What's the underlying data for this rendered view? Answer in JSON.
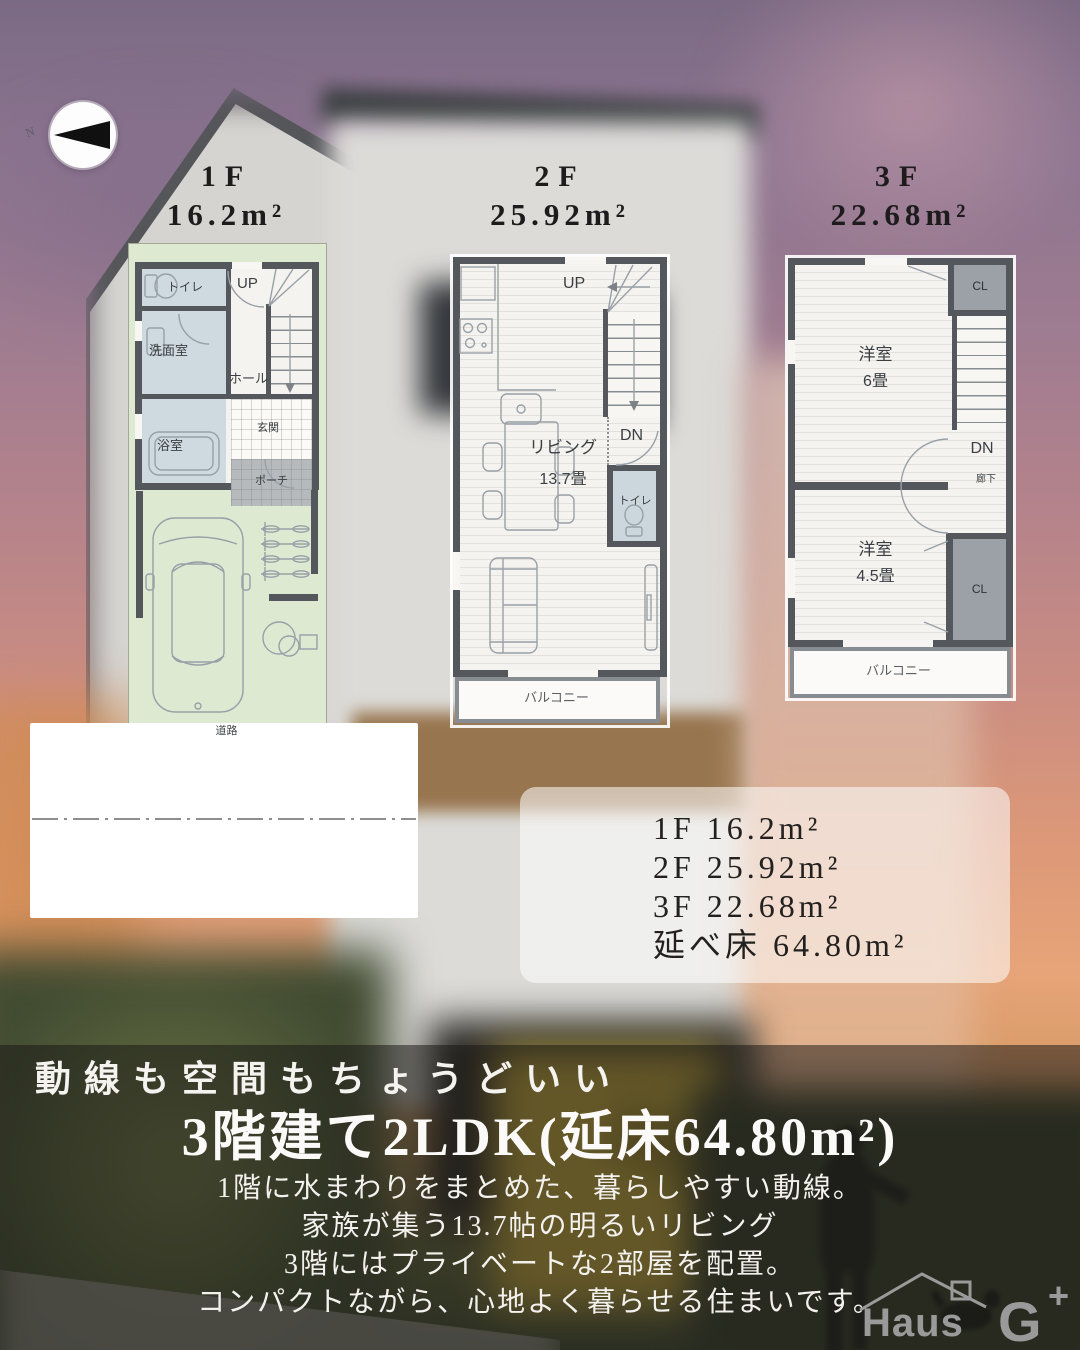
{
  "compass": {
    "north": "N"
  },
  "floor_titles": {
    "f1": {
      "label": "1F",
      "area": "16.2m²"
    },
    "f2": {
      "label": "2F",
      "area": "25.92m²"
    },
    "f3": {
      "label": "3F",
      "area": "22.68m²"
    }
  },
  "plan1f": {
    "toilet": "トイレ",
    "up": "UP",
    "washroom": "洗面室",
    "hall": "ホール",
    "bath": "浴室",
    "entrance": "玄関",
    "porch": "ポーチ",
    "road": "道路"
  },
  "plan2f": {
    "up": "UP",
    "dn": "DN",
    "living": "リビング",
    "living_size": "13.7畳",
    "toilet": "トイレ",
    "balcony": "バルコニー"
  },
  "plan3f": {
    "cl_top": "CL",
    "cl_bottom": "CL",
    "dn": "DN",
    "corridor": "廊下",
    "room6": "洋室",
    "room6_size": "6畳",
    "room45": "洋室",
    "room45_size": "4.5畳",
    "balcony": "バルコニー"
  },
  "summary": {
    "f1": "1F 16.2m²",
    "f2": "2F 25.92m²",
    "f3": "3F 22.68m²",
    "total": "延べ床 64.80m²"
  },
  "caption": {
    "tagline": "動線も空間もちょうどいい",
    "headline": "3階建て2LDK(延床64.80m²)",
    "desc1": "1階に水まわりをまとめた、暮らしやすい動線。",
    "desc2": "家族が集う13.7帖の明るいリビング",
    "desc3": "3階にはプライベートな2部屋を配置。",
    "desc4": "コンパクトながら、心地よく暮らせる住まいです。"
  },
  "logo": {
    "haus": "Haus",
    "g": "G",
    "plus": "+"
  },
  "colors": {
    "wall": "#54585d",
    "plot_green": "#dee9d2",
    "overlay": "rgba(24,23,22,0.52)"
  }
}
